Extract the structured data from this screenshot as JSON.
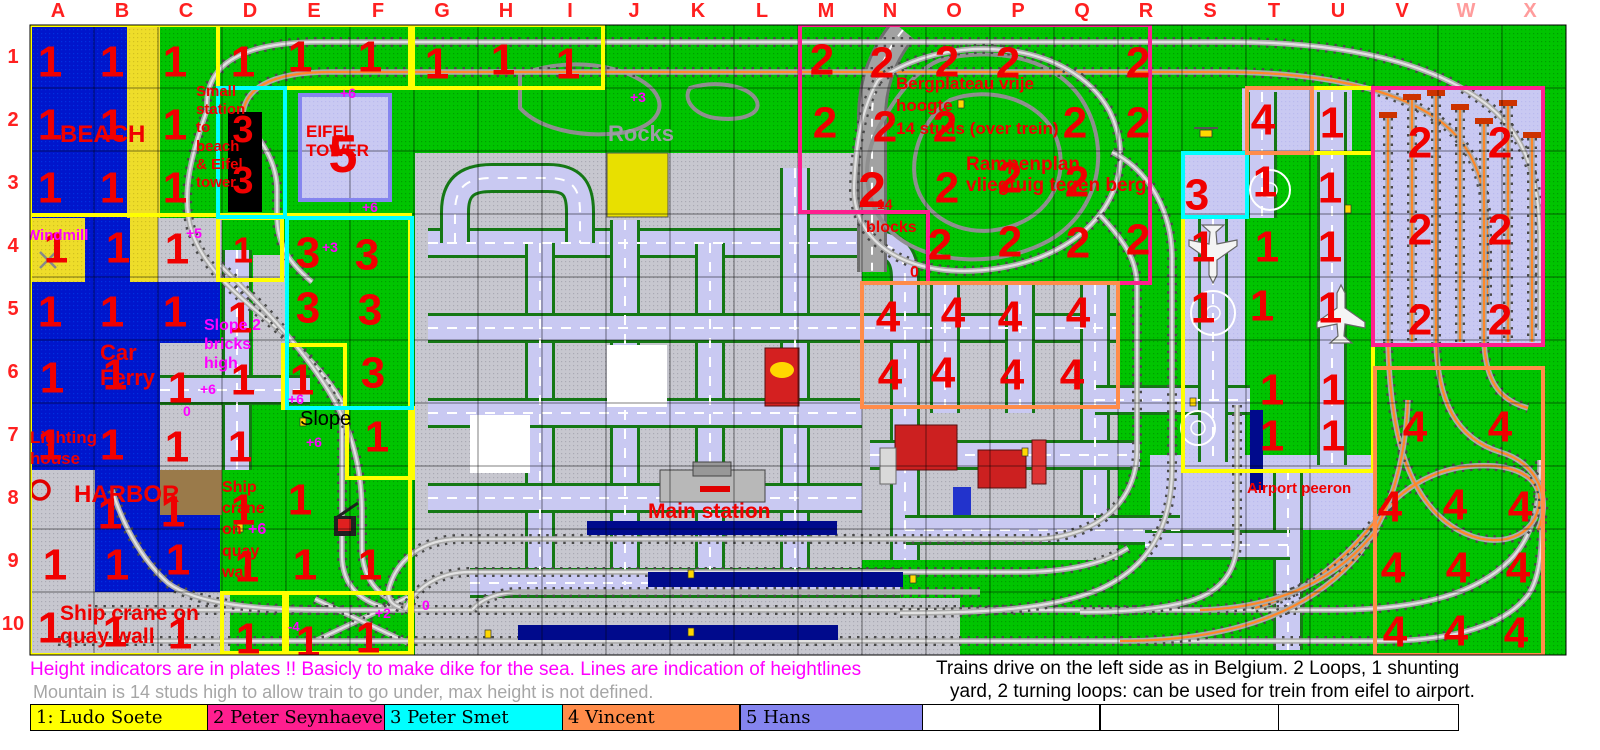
{
  "grid": {
    "columns": [
      "A",
      "B",
      "C",
      "D",
      "E",
      "F",
      "G",
      "H",
      "I",
      "J",
      "K",
      "L",
      "M",
      "N",
      "O",
      "P",
      "Q",
      "R",
      "S",
      "T",
      "U",
      "V",
      "W",
      "X"
    ],
    "rows": [
      "1",
      "2",
      "3",
      "4",
      "5",
      "6",
      "7",
      "8",
      "9",
      "10"
    ],
    "label_color": "#ff2020",
    "faded_columns": [
      "W",
      "X"
    ],
    "faded_color": "#ff9c9c"
  },
  "owners": {
    "1": {
      "name": "Ludo Soete",
      "color": "#ffff00"
    },
    "2": {
      "name": "Peter Seynhaeve",
      "color": "#ff1f8f"
    },
    "3": {
      "name": "Peter Smet",
      "color": "#00ffff"
    },
    "4": {
      "name": "Vincent",
      "color": "#ff8c4a"
    },
    "5": {
      "name": "Hans",
      "color": "#8585ef"
    }
  },
  "marker_color": "#f00000",
  "markers": [
    [
      50,
      62,
      "1"
    ],
    [
      112,
      62,
      "1"
    ],
    [
      175,
      62,
      "1"
    ],
    [
      243,
      62,
      "1"
    ],
    [
      300,
      57,
      "1"
    ],
    [
      370,
      57,
      "1"
    ],
    [
      437,
      64,
      "1"
    ],
    [
      503,
      60,
      "1"
    ],
    [
      568,
      64,
      "1"
    ],
    [
      50,
      125,
      "1"
    ],
    [
      112,
      125,
      "1"
    ],
    [
      175,
      125,
      "1"
    ],
    [
      50,
      188,
      "1"
    ],
    [
      112,
      188,
      "1"
    ],
    [
      175,
      188,
      "1"
    ],
    [
      56,
      248,
      "1"
    ],
    [
      118,
      248,
      "1"
    ],
    [
      177,
      249,
      "1"
    ],
    [
      243,
      250,
      "1",
      36
    ],
    [
      50,
      312,
      "1"
    ],
    [
      112,
      312,
      "1"
    ],
    [
      175,
      312,
      "1"
    ],
    [
      240,
      318,
      "1"
    ],
    [
      52,
      378,
      "1"
    ],
    [
      115,
      375,
      "1"
    ],
    [
      180,
      388,
      "1"
    ],
    [
      243,
      380,
      "1"
    ],
    [
      302,
      380,
      "1"
    ],
    [
      50,
      445,
      "1"
    ],
    [
      112,
      445,
      "1"
    ],
    [
      177,
      447,
      "1"
    ],
    [
      240,
      447,
      "1"
    ],
    [
      377,
      437,
      "1"
    ],
    [
      110,
      514,
      "1"
    ],
    [
      173,
      512,
      "1"
    ],
    [
      243,
      510,
      "1"
    ],
    [
      300,
      500,
      "1"
    ],
    [
      55,
      565,
      "1"
    ],
    [
      117,
      565,
      "1"
    ],
    [
      178,
      560,
      "1"
    ],
    [
      247,
      567,
      "1"
    ],
    [
      305,
      565,
      "1"
    ],
    [
      370,
      565,
      "1"
    ],
    [
      50,
      628,
      "1"
    ],
    [
      115,
      632,
      "1"
    ],
    [
      180,
      634,
      "1"
    ],
    [
      248,
      639,
      "1"
    ],
    [
      308,
      642,
      "1"
    ],
    [
      368,
      638,
      "1"
    ],
    [
      1332,
      123,
      "1"
    ],
    [
      1265,
      182,
      "1"
    ],
    [
      1330,
      188,
      "1"
    ],
    [
      1203,
      247,
      "1"
    ],
    [
      1267,
      247,
      "1"
    ],
    [
      1330,
      247,
      "1"
    ],
    [
      1203,
      308,
      "1"
    ],
    [
      1262,
      306,
      "1"
    ],
    [
      1330,
      308,
      "1"
    ],
    [
      1272,
      390,
      "1"
    ],
    [
      1333,
      390,
      "1"
    ],
    [
      1272,
      436,
      "1"
    ],
    [
      1333,
      436,
      "1"
    ],
    [
      822,
      60,
      "2"
    ],
    [
      882,
      63,
      "2"
    ],
    [
      947,
      62,
      "2"
    ],
    [
      1008,
      63,
      "2"
    ],
    [
      1138,
      63,
      "2"
    ],
    [
      825,
      123,
      "2"
    ],
    [
      885,
      127,
      "2"
    ],
    [
      945,
      127,
      "2"
    ],
    [
      1075,
      123,
      "2"
    ],
    [
      1138,
      123,
      "2"
    ],
    [
      872,
      190,
      "2",
      50
    ],
    [
      947,
      188,
      "2"
    ],
    [
      1010,
      178,
      "2"
    ],
    [
      1077,
      182,
      "2"
    ],
    [
      940,
      245,
      "2"
    ],
    [
      1010,
      242,
      "2"
    ],
    [
      1078,
      243,
      "2"
    ],
    [
      1138,
      240,
      "2"
    ],
    [
      1420,
      143,
      "2"
    ],
    [
      1500,
      143,
      "2"
    ],
    [
      1420,
      230,
      "2"
    ],
    [
      1500,
      230,
      "2"
    ],
    [
      1420,
      320,
      "2"
    ],
    [
      1500,
      320,
      "2"
    ],
    [
      243,
      130,
      "3",
      38
    ],
    [
      243,
      181,
      "3",
      38
    ],
    [
      308,
      253,
      "3"
    ],
    [
      367,
      255,
      "3"
    ],
    [
      308,
      308,
      "3"
    ],
    [
      370,
      310,
      "3"
    ],
    [
      373,
      373,
      "3"
    ],
    [
      1197,
      195,
      "3"
    ],
    [
      888,
      317,
      "4"
    ],
    [
      953,
      313,
      "4"
    ],
    [
      1010,
      317,
      "4"
    ],
    [
      1078,
      313,
      "4"
    ],
    [
      890,
      375,
      "4"
    ],
    [
      943,
      373,
      "4"
    ],
    [
      1012,
      375,
      "4"
    ],
    [
      1072,
      375,
      "4"
    ],
    [
      1263,
      120,
      "4"
    ],
    [
      1415,
      427,
      "4"
    ],
    [
      1500,
      427,
      "4"
    ],
    [
      1390,
      507,
      "4"
    ],
    [
      1455,
      505,
      "4"
    ],
    [
      1520,
      507,
      "4"
    ],
    [
      1393,
      568,
      "4"
    ],
    [
      1458,
      568,
      "4"
    ],
    [
      1518,
      568,
      "4"
    ],
    [
      1395,
      632,
      "4"
    ],
    [
      1456,
      631,
      "4"
    ],
    [
      1516,
      633,
      "4"
    ],
    [
      343,
      155,
      "5",
      52
    ]
  ],
  "labels": [
    {
      "t": "BEACH",
      "x": 60,
      "y": 142,
      "c": "#f00000",
      "s": 24,
      "b": 1
    },
    {
      "t": "Small",
      "x": 196,
      "y": 96,
      "c": "#f00000",
      "s": 15,
      "b": 1
    },
    {
      "t": "station",
      "x": 196,
      "y": 114,
      "c": "#f00000",
      "s": 15,
      "b": 1
    },
    {
      "t": "to",
      "x": 196,
      "y": 132,
      "c": "#f00000",
      "s": 15,
      "b": 1
    },
    {
      "t": "beach",
      "x": 196,
      "y": 151,
      "c": "#f00000",
      "s": 15,
      "b": 1
    },
    {
      "t": "& Eifel",
      "x": 196,
      "y": 169,
      "c": "#f00000",
      "s": 15,
      "b": 1
    },
    {
      "t": "tower",
      "x": 196,
      "y": 187,
      "c": "#f00000",
      "s": 15,
      "b": 1
    },
    {
      "t": "EIFEL",
      "x": 306,
      "y": 137,
      "c": "#f00000",
      "s": 17,
      "b": 1
    },
    {
      "t": "TOWER",
      "x": 306,
      "y": 156,
      "c": "#f00000",
      "s": 17,
      "b": 1
    },
    {
      "t": "Windmill",
      "x": 26,
      "y": 240,
      "c": "#ff00ff",
      "s": 15,
      "b": 1
    },
    {
      "t": "Car",
      "x": 100,
      "y": 360,
      "c": "#f00000",
      "s": 22,
      "b": 1
    },
    {
      "t": "Ferry",
      "x": 100,
      "y": 385,
      "c": "#f00000",
      "s": 22,
      "b": 1
    },
    {
      "t": "Lighting",
      "x": 30,
      "y": 443,
      "c": "#f00000",
      "s": 17,
      "b": 1
    },
    {
      "t": "house",
      "x": 30,
      "y": 464,
      "c": "#f00000",
      "s": 17,
      "b": 1
    },
    {
      "t": "HARBOR",
      "x": 74,
      "y": 502,
      "c": "#f00000",
      "s": 24,
      "b": 1
    },
    {
      "t": "Ship",
      "x": 222,
      "y": 492,
      "c": "#f00000",
      "s": 16,
      "b": 1
    },
    {
      "t": "crane",
      "x": 222,
      "y": 513,
      "c": "#f00000",
      "s": 16,
      "b": 1
    },
    {
      "t": "on",
      "x": 222,
      "y": 534,
      "c": "#f00000",
      "s": 16,
      "b": 1
    },
    {
      "t": "+6",
      "x": 248,
      "y": 534,
      "c": "#ff00ff",
      "s": 16,
      "b": 1
    },
    {
      "t": "quay",
      "x": 222,
      "y": 556,
      "c": "#f00000",
      "s": 16,
      "b": 1
    },
    {
      "t": "wall",
      "x": 222,
      "y": 577,
      "c": "#f00000",
      "s": 16,
      "b": 1
    },
    {
      "t": "Ship crane on",
      "x": 60,
      "y": 620,
      "c": "#f00000",
      "s": 21,
      "b": 1
    },
    {
      "t": "quay wall",
      "x": 60,
      "y": 643,
      "c": "#f00000",
      "s": 21,
      "b": 1
    },
    {
      "t": "Slope 2",
      "x": 204,
      "y": 330,
      "c": "#ff00ff",
      "s": 16,
      "b": 1
    },
    {
      "t": "bricks",
      "x": 204,
      "y": 349,
      "c": "#ff00ff",
      "s": 16,
      "b": 1
    },
    {
      "t": "high",
      "x": 204,
      "y": 368,
      "c": "#ff00ff",
      "s": 16,
      "b": 1
    },
    {
      "t": "Slope",
      "x": 300,
      "y": 425,
      "c": "#000000",
      "s": 20,
      "b": 0
    },
    {
      "t": "Rocks",
      "x": 608,
      "y": 141,
      "c": "#9c9ca4",
      "s": 22,
      "b": 1
    },
    {
      "t": "Bergplateau vrije",
      "x": 896,
      "y": 89,
      "c": "#f00000",
      "s": 17,
      "b": 1
    },
    {
      "t": "hoogte",
      "x": 896,
      "y": 111,
      "c": "#f00000",
      "s": 17,
      "b": 1
    },
    {
      "t": "14 studs (over trein)",
      "x": 896,
      "y": 134,
      "c": "#f00000",
      "s": 17,
      "b": 1
    },
    {
      "t": "Rampenplan",
      "x": 966,
      "y": 170,
      "c": "#f00000",
      "s": 19,
      "b": 1
    },
    {
      "t": "vliegtuig tegen berg",
      "x": 966,
      "y": 191,
      "c": "#f00000",
      "s": 19,
      "b": 1
    },
    {
      "t": "14",
      "x": 877,
      "y": 209,
      "c": "#f00000",
      "s": 14,
      "b": 1
    },
    {
      "t": "blocks",
      "x": 866,
      "y": 232,
      "c": "#f00000",
      "s": 16,
      "b": 1
    },
    {
      "t": "0",
      "x": 910,
      "y": 277,
      "c": "#f00000",
      "s": 16,
      "b": 1
    },
    {
      "t": "Main station",
      "x": 648,
      "y": 518,
      "c": "#f00000",
      "s": 21,
      "b": 1
    },
    {
      "t": "Airport peeron",
      "x": 1247,
      "y": 493,
      "c": "#f00000",
      "s": 15,
      "b": 1
    },
    {
      "t": "+6",
      "x": 340,
      "y": 98,
      "c": "#ff00ff",
      "s": 14,
      "b": 1
    },
    {
      "t": "+6",
      "x": 362,
      "y": 212,
      "c": "#ff00ff",
      "s": 14,
      "b": 1
    },
    {
      "t": "+5",
      "x": 186,
      "y": 238,
      "c": "#ff00ff",
      "s": 14,
      "b": 1
    },
    {
      "t": "+3",
      "x": 322,
      "y": 252,
      "c": "#ff00ff",
      "s": 14,
      "b": 1
    },
    {
      "t": "+3",
      "x": 630,
      "y": 102,
      "c": "#ff00ff",
      "s": 14,
      "b": 1
    },
    {
      "t": "+6",
      "x": 200,
      "y": 394,
      "c": "#ff00ff",
      "s": 14,
      "b": 1
    },
    {
      "t": "+6",
      "x": 288,
      "y": 404,
      "c": "#ff00ff",
      "s": 14,
      "b": 1
    },
    {
      "t": "+6",
      "x": 306,
      "y": 447,
      "c": "#ff00ff",
      "s": 14,
      "b": 1
    },
    {
      "t": "0",
      "x": 183,
      "y": 416,
      "c": "#ff00ff",
      "s": 14,
      "b": 1
    },
    {
      "t": "0",
      "x": 422,
      "y": 610,
      "c": "#ff00ff",
      "s": 14,
      "b": 1
    },
    {
      "t": "+2",
      "x": 375,
      "y": 618,
      "c": "#ff00ff",
      "s": 14,
      "b": 1
    },
    {
      "t": "-4",
      "x": 288,
      "y": 631,
      "c": "#ff00ff",
      "s": 13,
      "b": 1
    }
  ],
  "legend": {
    "entries": [
      {
        "label": "1: Ludo Soete",
        "color": "#ffff00"
      },
      {
        "label": "2 Peter Seynhaeve",
        "color": "#ff1f8f"
      },
      {
        "label": "3 Peter Smet",
        "color": "#00ffff"
      },
      {
        "label": "4 Vincent",
        "color": "#ff8c4a"
      },
      {
        "label": "5 Hans",
        "color": "#8585ef"
      },
      {
        "label": "",
        "color": "#ffffff"
      },
      {
        "label": "",
        "color": "#ffffff"
      },
      {
        "label": "",
        "color": "#ffffff"
      }
    ]
  },
  "notes": {
    "height_note": "Height indicators are in plates !! Basicly to make dike for the sea. Lines are indication of heightlines",
    "mountain_note": "Mountain is 14 studs high to allow train to go under, max height is not defined.",
    "traffic_note_line1": "Trains drive on the left side as in Belgium. 2 Loops, 1 shunting",
    "traffic_note_line2": "yard, 2 turning loops: can be used for trein from eifel to airport."
  }
}
